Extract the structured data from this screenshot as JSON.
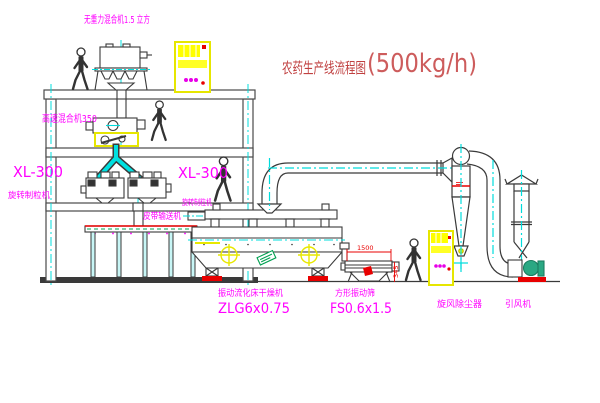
{
  "title": {
    "name": "农药生产线流程图",
    "capacity": "(500kg/h)"
  },
  "equipment": {
    "gravity_mixer": {
      "label": "无重力混合机1.5 立方"
    },
    "high_speed_mixer": {
      "label": "高速混合机350"
    },
    "granulator_left": {
      "model": "XL-300",
      "label": "旋转制粒机"
    },
    "granulator_right": {
      "model": "XL-300",
      "label": "旋转制粒机"
    },
    "belt_conveyor": {
      "label": "皮带输送机"
    },
    "fluid_bed_dryer": {
      "label": "振动流化床干燥机",
      "model": "ZLG6x0.75"
    },
    "square_sieve": {
      "label": "方形振动筛",
      "model": "FS0.6x1.5"
    },
    "cyclone": {
      "label": "旋风除尘器"
    },
    "induced_draft_fan": {
      "label": "引风机"
    }
  },
  "dimensions": {
    "sieve_width": "1500",
    "sieve_height": "345"
  },
  "colors": {
    "label_magenta": "#ff00ff",
    "title_red": "#c04040",
    "capacity_red": "#cd5c5c",
    "line_dark": "#3a3a3a",
    "centerline_cyan": "#00dcdc",
    "highlight_yellow": "#ffff00",
    "alert_red": "#e80000",
    "accent_green": "#00a050",
    "fan_teal": "#2aa883"
  }
}
